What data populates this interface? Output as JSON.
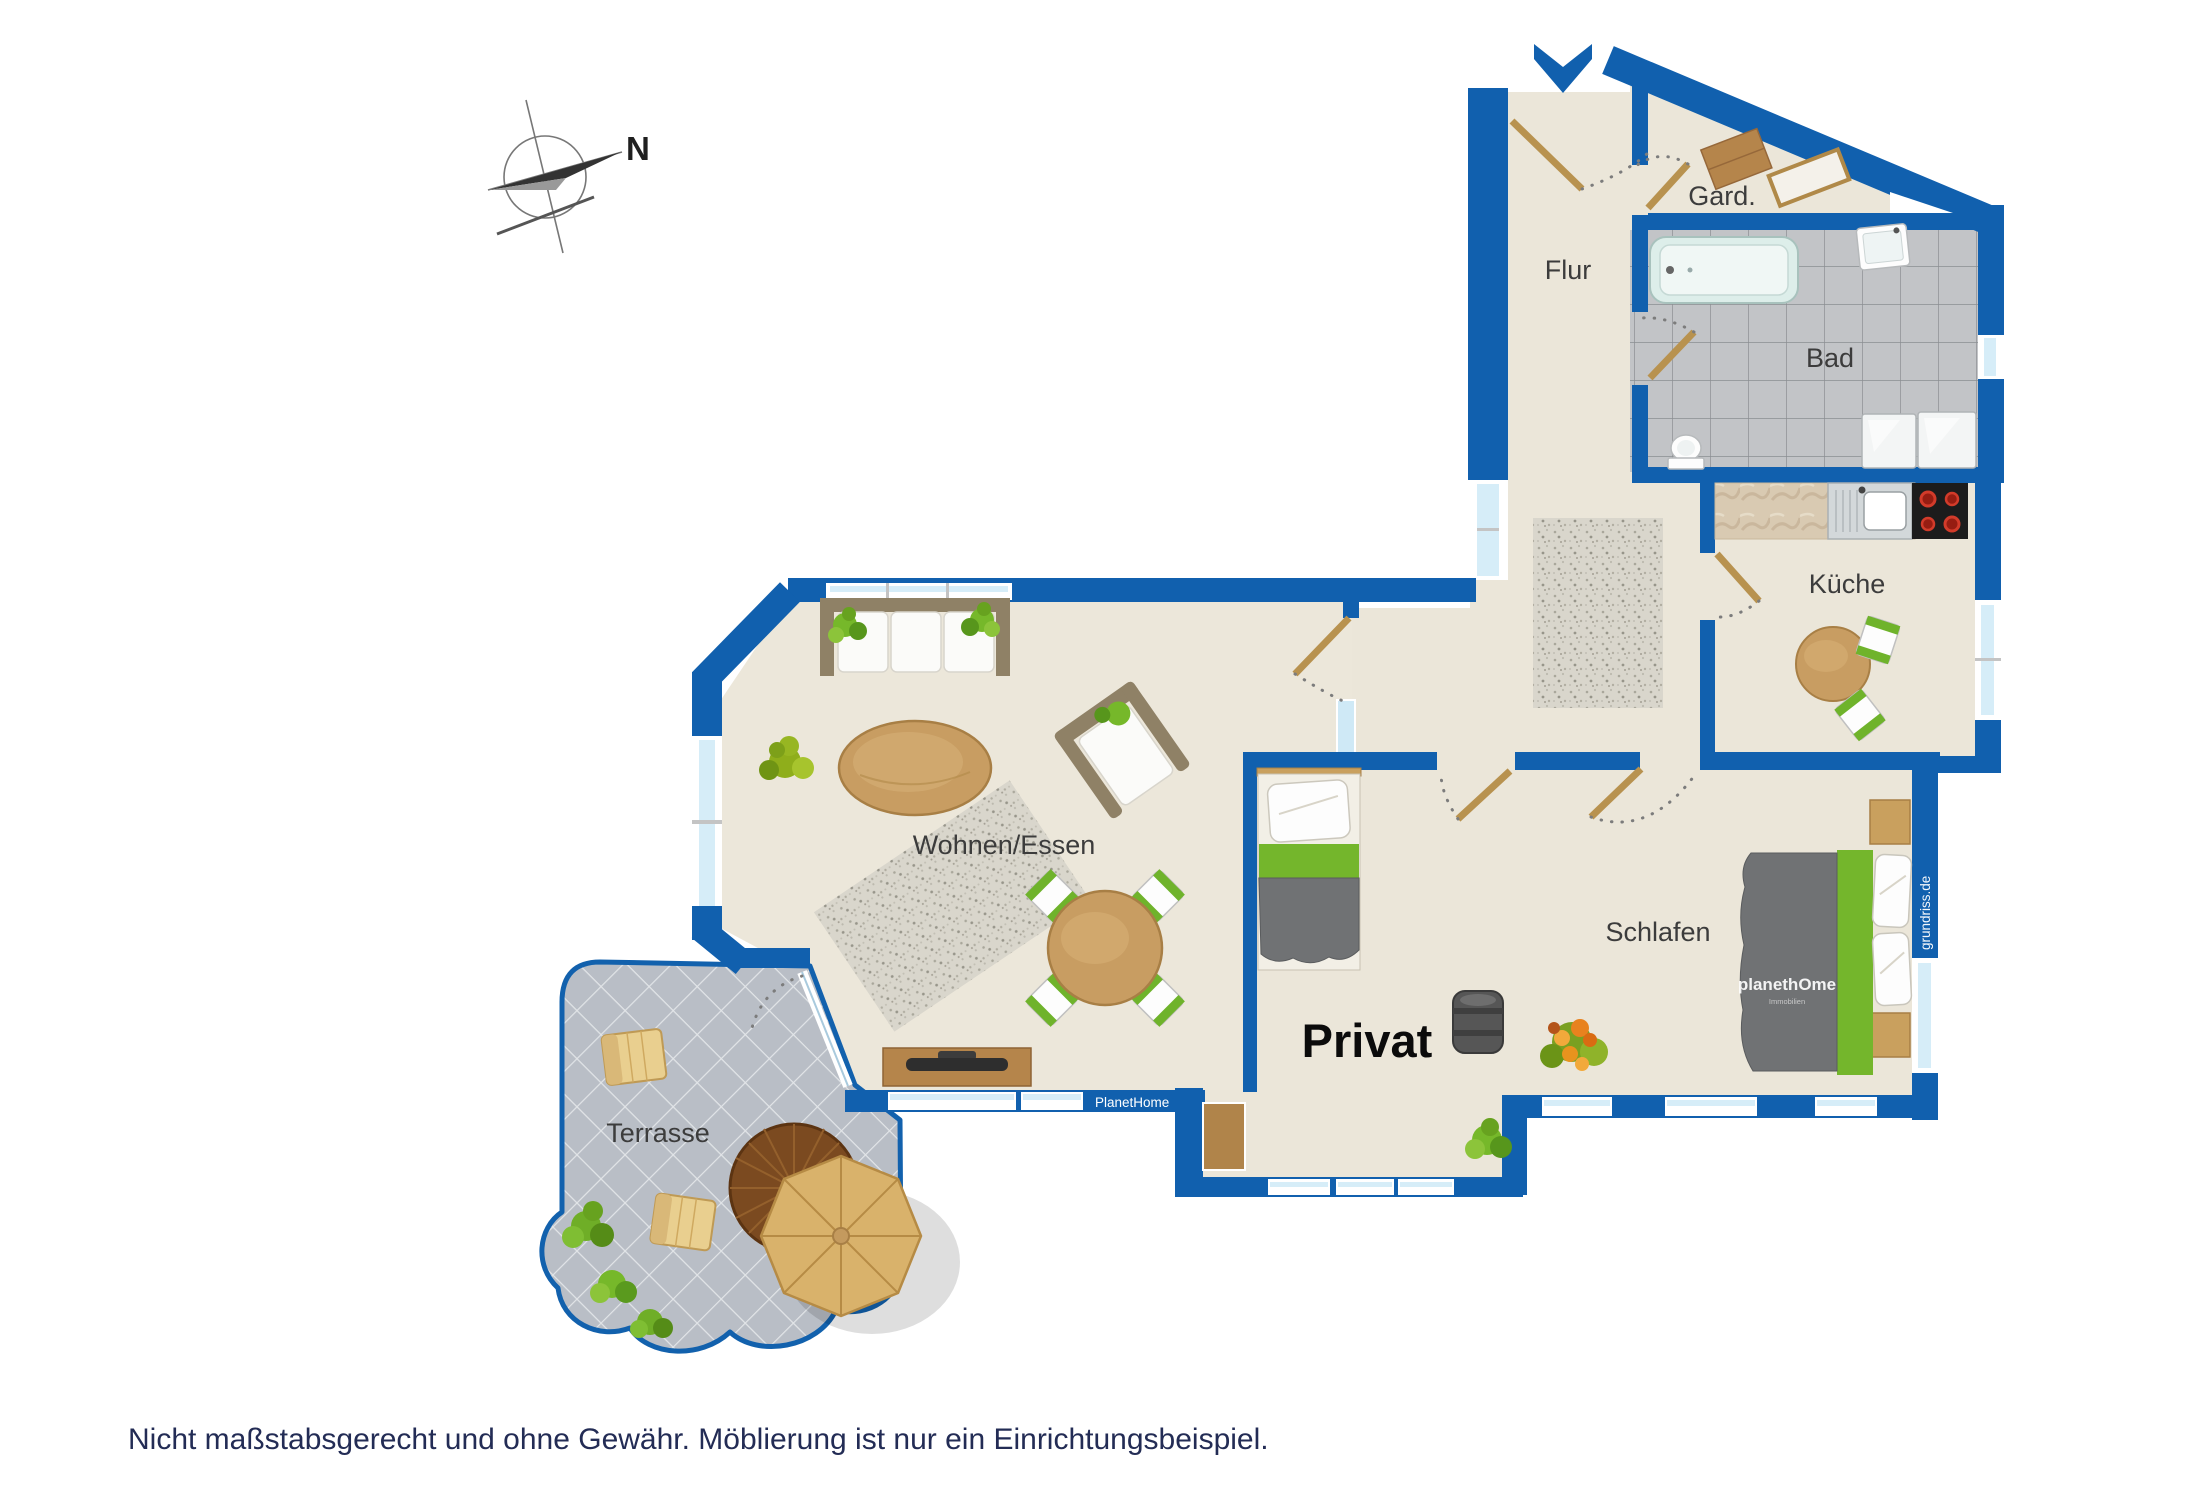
{
  "disclaimer": {
    "text": "Nicht maßstabsgerecht und ohne Gewähr. Möblierung ist nur ein Einrichtungsbeispiel."
  },
  "compass": {
    "north_label": "N"
  },
  "rooms": {
    "flur": "Flur",
    "garderobe": "Gard.",
    "bad": "Bad",
    "kueche": "Küche",
    "wohnen_essen": "Wohnen/Essen",
    "privat": "Privat",
    "schlafen": "Schlafen",
    "terrasse": "Terrasse"
  },
  "branding": {
    "planethome_sill": "PlanetHome",
    "planethome_watermark": "planethOme",
    "planethome_watermark_sub": "Immobilien",
    "grundriss_watermark": "grundriss.de"
  },
  "colors": {
    "wall_blue": "#1160ae",
    "floor_beige": "#ebe6d9",
    "bath_tile_gray": "#c2c4c7",
    "terrace_tile_gray": "#b9bec6",
    "window_glass": "#d6edf8",
    "accent_green": "#74b62c",
    "wood_light": "#c89d62",
    "wood_dark": "#7b4a20",
    "label_gray": "#3c3c3c",
    "disclaimer_navy": "#232c55"
  }
}
